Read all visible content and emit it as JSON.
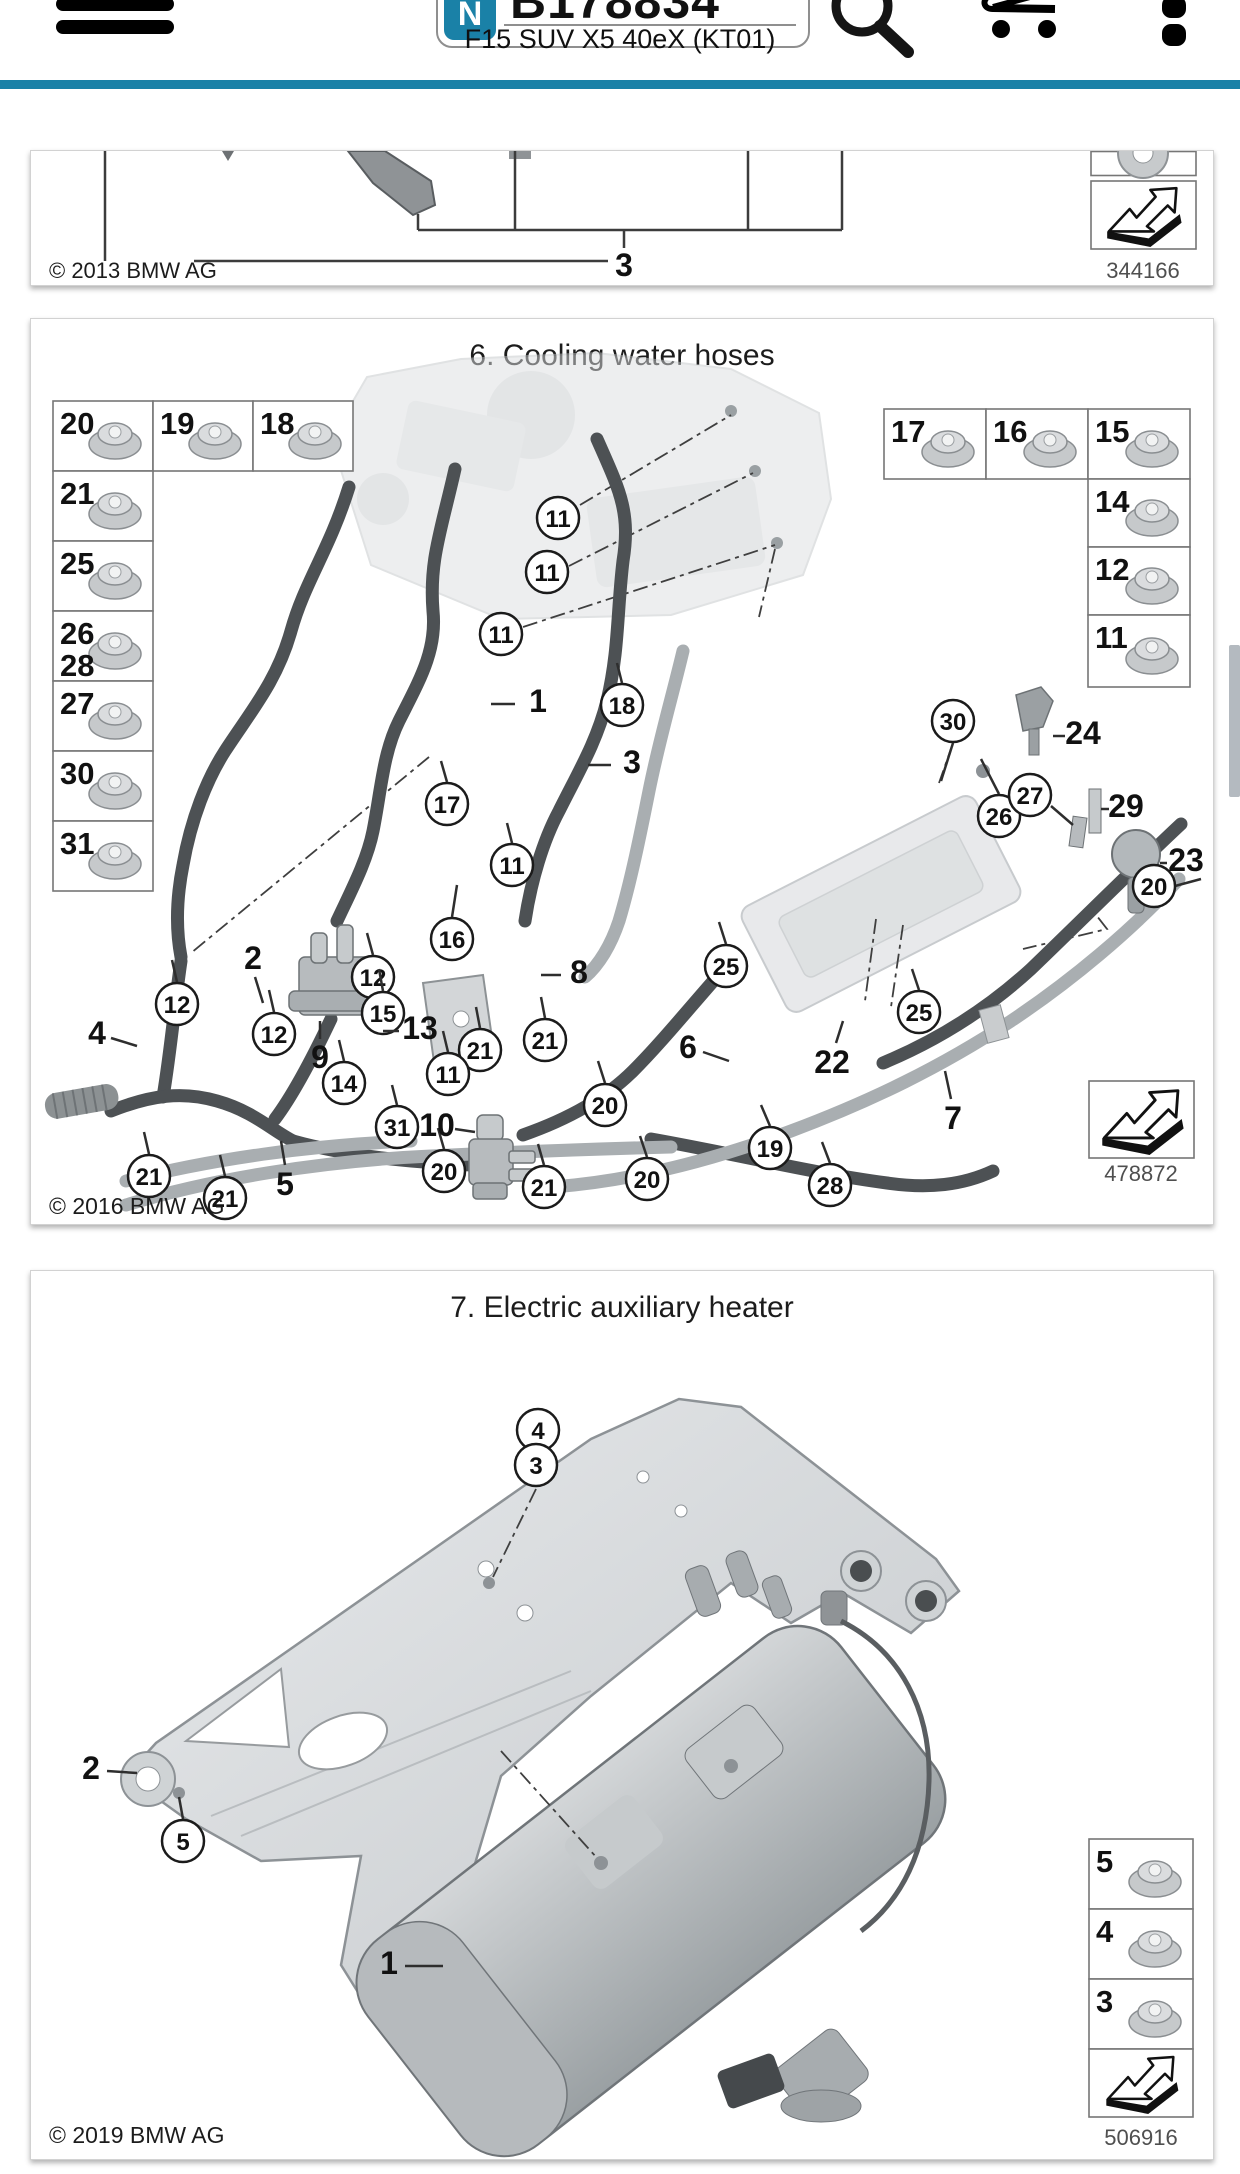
{
  "header": {
    "part_number": "B178834",
    "badge": "N",
    "subtitle": "F15 SUV X5 40eX (KT01)",
    "accent_color": "#1a81a7"
  },
  "panels": [
    {
      "title": "",
      "copyright": "© 2013 BMW AG",
      "doc_number": "344166",
      "callout_label": "3"
    },
    {
      "title": "6. Cooling water hoses",
      "copyright": "© 2016 BMW AG",
      "doc_number": "478872",
      "legend": {
        "cells": [
          {
            "x": 22,
            "y": 82,
            "w": 100,
            "h": 70,
            "nums": [
              "20"
            ]
          },
          {
            "x": 122,
            "y": 82,
            "w": 100,
            "h": 70,
            "nums": [
              "19"
            ]
          },
          {
            "x": 222,
            "y": 82,
            "w": 100,
            "h": 70,
            "nums": [
              "18"
            ]
          },
          {
            "x": 22,
            "y": 152,
            "w": 100,
            "h": 70,
            "nums": [
              "21"
            ]
          },
          {
            "x": 22,
            "y": 222,
            "w": 100,
            "h": 70,
            "nums": [
              "25"
            ]
          },
          {
            "x": 22,
            "y": 292,
            "w": 100,
            "h": 70,
            "nums": [
              "26",
              "28"
            ]
          },
          {
            "x": 22,
            "y": 362,
            "w": 100,
            "h": 70,
            "nums": [
              "27"
            ]
          },
          {
            "x": 22,
            "y": 432,
            "w": 100,
            "h": 70,
            "nums": [
              "30"
            ]
          },
          {
            "x": 22,
            "y": 502,
            "w": 100,
            "h": 70,
            "nums": [
              "31"
            ]
          },
          {
            "x": 853,
            "y": 90,
            "w": 102,
            "h": 70,
            "nums": [
              "17"
            ]
          },
          {
            "x": 955,
            "y": 90,
            "w": 102,
            "h": 70,
            "nums": [
              "16"
            ]
          },
          {
            "x": 1057,
            "y": 90,
            "w": 102,
            "h": 70,
            "nums": [
              "15"
            ]
          },
          {
            "x": 1057,
            "y": 160,
            "w": 102,
            "h": 68,
            "nums": [
              "14"
            ]
          },
          {
            "x": 1057,
            "y": 228,
            "w": 102,
            "h": 68,
            "nums": [
              "12"
            ]
          },
          {
            "x": 1057,
            "y": 296,
            "w": 102,
            "h": 72,
            "nums": [
              "11"
            ]
          }
        ]
      },
      "callouts": [
        {
          "n": "11",
          "x": 527,
          "y": 199
        },
        {
          "n": "11",
          "x": 516,
          "y": 253
        },
        {
          "n": "11",
          "x": 470,
          "y": 315
        },
        {
          "n": "18",
          "x": 591,
          "y": 386,
          "l": [
            591,
            364,
            586,
            344
          ]
        },
        {
          "n": "17",
          "x": 416,
          "y": 485,
          "l": [
            416,
            463,
            410,
            442
          ]
        },
        {
          "n": "11",
          "x": 481,
          "y": 546,
          "l": [
            481,
            524,
            476,
            504
          ]
        },
        {
          "n": "16",
          "x": 421,
          "y": 620,
          "l": [
            421,
            598,
            426,
            566
          ]
        },
        {
          "n": "12",
          "x": 342,
          "y": 658,
          "l": [
            342,
            636,
            336,
            614
          ]
        },
        {
          "n": "12",
          "x": 146,
          "y": 685,
          "l": [
            146,
            663,
            141,
            641
          ]
        },
        {
          "n": "12",
          "x": 243,
          "y": 715,
          "l": [
            243,
            693,
            238,
            671
          ]
        },
        {
          "n": "15",
          "x": 352,
          "y": 694,
          "l": [
            352,
            672,
            348,
            650
          ]
        },
        {
          "n": "21",
          "x": 449,
          "y": 731,
          "l": [
            449,
            709,
            445,
            688
          ]
        },
        {
          "n": "21",
          "x": 514,
          "y": 721,
          "l": [
            514,
            699,
            510,
            678
          ]
        },
        {
          "n": "14",
          "x": 313,
          "y": 764,
          "l": [
            313,
            742,
            308,
            721
          ]
        },
        {
          "n": "11",
          "x": 417,
          "y": 755,
          "l": [
            417,
            733,
            412,
            712
          ]
        },
        {
          "n": "31",
          "x": 366,
          "y": 808,
          "l": [
            366,
            786,
            361,
            766
          ]
        },
        {
          "n": "20",
          "x": 574,
          "y": 786,
          "l": [
            574,
            764,
            567,
            742
          ]
        },
        {
          "n": "21",
          "x": 118,
          "y": 857,
          "l": [
            118,
            835,
            113,
            813
          ]
        },
        {
          "n": "21",
          "x": 194,
          "y": 879,
          "l": [
            194,
            857,
            189,
            836
          ]
        },
        {
          "n": "20",
          "x": 413,
          "y": 852,
          "l": [
            413,
            830,
            407,
            809
          ]
        },
        {
          "n": "21",
          "x": 513,
          "y": 868,
          "l": [
            513,
            846,
            507,
            825
          ]
        },
        {
          "n": "20",
          "x": 616,
          "y": 860,
          "l": [
            616,
            838,
            609,
            817
          ]
        },
        {
          "n": "19",
          "x": 739,
          "y": 829,
          "l": [
            739,
            807,
            730,
            786
          ]
        },
        {
          "n": "25",
          "x": 695,
          "y": 647,
          "l": [
            695,
            625,
            688,
            603
          ]
        },
        {
          "n": "25",
          "x": 888,
          "y": 693,
          "l": [
            888,
            671,
            881,
            650
          ]
        },
        {
          "n": "28",
          "x": 799,
          "y": 866,
          "l": [
            799,
            844,
            791,
            823
          ]
        },
        {
          "n": "30",
          "x": 922,
          "y": 402,
          "l": [
            922,
            424,
            910,
            462
          ]
        },
        {
          "n": "26",
          "x": 968,
          "y": 497,
          "l": [
            968,
            475,
            950,
            440
          ]
        },
        {
          "n": "27",
          "x": 999,
          "y": 476,
          "l": [
            1020,
            487,
            1042,
            506
          ]
        },
        {
          "n": "20",
          "x": 1123,
          "y": 567,
          "l": [
            1144,
            567,
            1170,
            560
          ]
        }
      ],
      "labels": [
        {
          "n": "1",
          "x": 507,
          "y": 393,
          "l": [
            460,
            385,
            484,
            385
          ]
        },
        {
          "n": "3",
          "x": 601,
          "y": 454,
          "l": [
            557,
            446,
            580,
            446
          ]
        },
        {
          "n": "2",
          "x": 222,
          "y": 650,
          "l": [
            224,
            658,
            232,
            684
          ]
        },
        {
          "n": "4",
          "x": 66,
          "y": 725,
          "l": [
            80,
            719,
            106,
            727
          ]
        },
        {
          "n": "8",
          "x": 548,
          "y": 664,
          "l": [
            510,
            656,
            530,
            656
          ]
        },
        {
          "n": "9",
          "x": 289,
          "y": 749,
          "l": [
            289,
            720,
            289,
            702
          ]
        },
        {
          "n": "13",
          "x": 389,
          "y": 720,
          "l": [
            352,
            712,
            368,
            712
          ]
        },
        {
          "n": "10",
          "x": 406,
          "y": 817,
          "l": [
            424,
            810,
            444,
            813
          ]
        },
        {
          "n": "5",
          "x": 254,
          "y": 876,
          "l": [
            254,
            846,
            250,
            822
          ]
        },
        {
          "n": "6",
          "x": 657,
          "y": 739,
          "l": [
            672,
            733,
            698,
            742
          ]
        },
        {
          "n": "22",
          "x": 801,
          "y": 754,
          "l": [
            805,
            724,
            812,
            702
          ]
        },
        {
          "n": "7",
          "x": 922,
          "y": 810,
          "l": [
            920,
            780,
            914,
            752
          ]
        },
        {
          "n": "24",
          "x": 1052,
          "y": 425,
          "l": [
            1022,
            417,
            1034,
            417
          ]
        },
        {
          "n": "29",
          "x": 1095,
          "y": 498,
          "l": [
            1070,
            490,
            1078,
            490
          ]
        },
        {
          "n": "23",
          "x": 1155,
          "y": 552,
          "l": [
            1129,
            544,
            1136,
            544
          ]
        }
      ]
    },
    {
      "title": "7. Electric auxiliary heater",
      "copyright": "© 2019 BMW AG",
      "doc_number": "506916",
      "legend": {
        "cells": [
          {
            "x": 1058,
            "y": 568,
            "w": 104,
            "h": 70,
            "nums": [
              "5"
            ]
          },
          {
            "x": 1058,
            "y": 638,
            "w": 104,
            "h": 70,
            "nums": [
              "4"
            ]
          },
          {
            "x": 1058,
            "y": 708,
            "w": 104,
            "h": 70,
            "nums": [
              "3"
            ]
          }
        ]
      },
      "callouts": [
        {
          "n": "4",
          "x": 507,
          "y": 159
        },
        {
          "n": "3",
          "x": 505,
          "y": 194
        },
        {
          "n": "5",
          "x": 152,
          "y": 570,
          "l": [
            152,
            548,
            148,
            526
          ]
        }
      ],
      "labels": [
        {
          "n": "2",
          "x": 60,
          "y": 508,
          "l": [
            76,
            500,
            106,
            502
          ]
        },
        {
          "n": "1",
          "x": 358,
          "y": 703,
          "l": [
            374,
            695,
            412,
            695
          ]
        }
      ]
    }
  ]
}
